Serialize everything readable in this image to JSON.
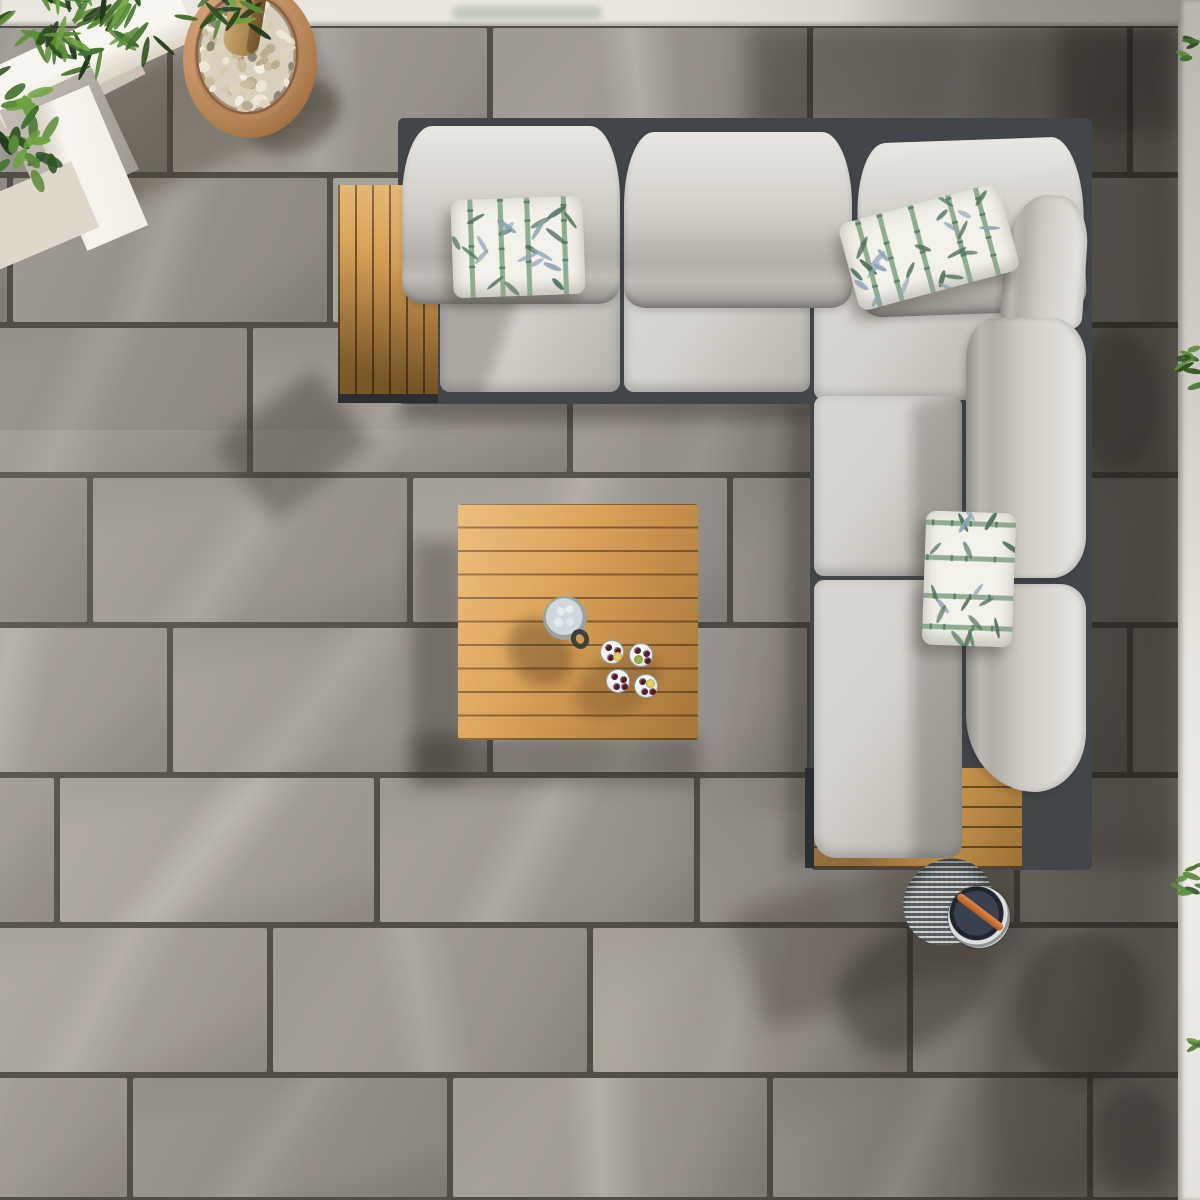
{
  "meta": {
    "type": "photograph",
    "subject": "Top-down aerial view of an outdoor patio with a light grey L-shaped corner sofa, teak tables, bamboo-print cushions, an olive tree in a terracotta pebble-topped pot, a drinks jug with tumblers of cherries, and a portable grill on large grey stone tiles",
    "width": 1200,
    "height": 1200
  },
  "palette": {
    "wall_light": "#e9e6df",
    "wall_mid": "#d9d6cf",
    "wall_dark": "#8f8c85",
    "wall_strip_top": "#b9b6af",
    "wall_strip_bottom": "#eeece6",
    "grout": "#514e48",
    "tile": "#a8a39b",
    "tile_shade": "#938e86",
    "tile_vein": "#cdc8c0",
    "frame": "#42454a",
    "frame_dark": "#2c2f32",
    "cushion": "#d3d1cb",
    "cushion_hi": "#e9e7e1",
    "cushion_low": "#94918c",
    "teak_hi": "#e5b065",
    "teak": "#d09b53",
    "teak_low": "#9c7134",
    "teak_gap": "rgba(30,20,5,0.55)",
    "pillow_bg": "#f2f1ea",
    "bamboo_green": "#7fa183",
    "bamboo_dark": "#4f7258",
    "bamboo_blue": "#8ea3b6",
    "terracotta_hi": "#d7ab83",
    "terracotta": "#c59468",
    "terracotta_low": "#8c5c34",
    "pebble_field": "#d8d0bd",
    "trunk_hi": "#c9a76e",
    "trunk_low": "#8a6a3e",
    "jug_rim": "#565c53",
    "ice": "#e7edef",
    "cherry": "#521c29",
    "lemon": "#e7d067",
    "lime": "#9cb251",
    "steel_hi": "#dde0de",
    "steel_low": "#6f7476",
    "grill_top": "#20242e",
    "grill_handle_hi": "#e0894a",
    "grill_handle_low": "#ad5a26"
  },
  "scene": {
    "floor": {
      "label": "Large grey stone-effect patio tiles with dark grout",
      "tile_width": 320,
      "tile_height": 150,
      "top": 25,
      "row_offsets": [
        -150,
        -310,
        -70,
        -230,
        -150,
        -263,
        -50,
        -190
      ]
    },
    "lighting": {
      "label": "Hard sunlight from the upper right casting diagonal shadows to the lower left"
    },
    "objects": {
      "sofa": {
        "label": "Light grey fabric corner sofa with rolled back cushions on a dark aluminium frame"
      },
      "left_side_table": {
        "label": "Teak slatted side table at the left end of the sofa"
      },
      "bottom_side_table": {
        "label": "Teak slatted side table at the bottom end of the sofa"
      },
      "coffee_table": {
        "label": "Square teak slatted coffee table"
      },
      "pillows": {
        "label": "Bamboo-leaf print scatter cushions",
        "count": 3
      },
      "jug": {
        "label": "Stoneware drinks jug filled with ice"
      },
      "glasses": {
        "label": "Tumblers with cherries and citrus slices",
        "count": 4
      },
      "grill": {
        "label": "Portable stainless grill lantern with orange handle"
      },
      "planter": {
        "label": "White rendered raised planter with stone coping"
      },
      "pot": {
        "label": "Terracotta pot topped with white pebbles around an olive trunk"
      },
      "olive_tree": {
        "label": "Olive tree foliage overhanging the planter corner"
      },
      "right_wall": {
        "label": "White wall edge with trailing green plant"
      }
    }
  },
  "plants": {
    "leaf_colors": [
      "#21381b",
      "#2f5222",
      "#44702f",
      "#5b8a3a",
      "#6da23f"
    ],
    "clusters": [
      {
        "name": "olive-canopy",
        "cx": 85,
        "cy": 32,
        "n": 62,
        "sx": 100,
        "sy": 55,
        "len": [
          22,
          40
        ],
        "wid": [
          4,
          7
        ]
      },
      {
        "name": "olive-overhang",
        "cx": 228,
        "cy": 16,
        "n": 16,
        "sx": 52,
        "sy": 28,
        "len": [
          20,
          34
        ],
        "wid": [
          4,
          6
        ]
      },
      {
        "name": "ficus-side",
        "cx": 24,
        "cy": 142,
        "n": 24,
        "sx": 42,
        "sy": 66,
        "len": [
          18,
          30
        ],
        "wid": [
          7,
          11
        ]
      }
    ],
    "wall_clusters": [
      {
        "cx": 42,
        "cy": 45,
        "n": 7
      },
      {
        "cx": 38,
        "cy": 370,
        "n": 9
      },
      {
        "cx": 40,
        "cy": 872,
        "n": 8
      },
      {
        "cx": 44,
        "cy": 1045,
        "n": 5
      }
    ]
  },
  "pot": {
    "pebble_count": 72,
    "pebble_colors": [
      "#ece6d6",
      "#ded4bc",
      "#cbbc9c",
      "#f1eee4",
      "#b9ad92",
      "#d6cab0",
      "#8f8673"
    ]
  },
  "drinks": {
    "jug": {
      "x": 565,
      "y": 618
    },
    "glasses": [
      {
        "x": 612,
        "y": 652,
        "fruits": [
          "cherry",
          "cherry",
          "cherry",
          "lemon"
        ]
      },
      {
        "x": 641,
        "y": 655,
        "fruits": [
          "cherry",
          "cherry",
          "lime",
          "cherry"
        ]
      },
      {
        "x": 618,
        "y": 681,
        "fruits": [
          "cherry",
          "cherry",
          "cherry",
          "cherry"
        ]
      },
      {
        "x": 646,
        "y": 686,
        "fruits": [
          "cherry",
          "lemon",
          "cherry",
          "cherry"
        ]
      }
    ]
  },
  "pillow_layouts": [
    {
      "name": "pillow-left",
      "w": 132,
      "h": 98,
      "horizontal_stalks": false
    },
    {
      "name": "pillow-corner",
      "w": 166,
      "h": 90,
      "horizontal_stalks": false
    },
    {
      "name": "pillow-right-arm",
      "w": 90,
      "h": 134,
      "horizontal_stalks": true
    }
  ]
}
